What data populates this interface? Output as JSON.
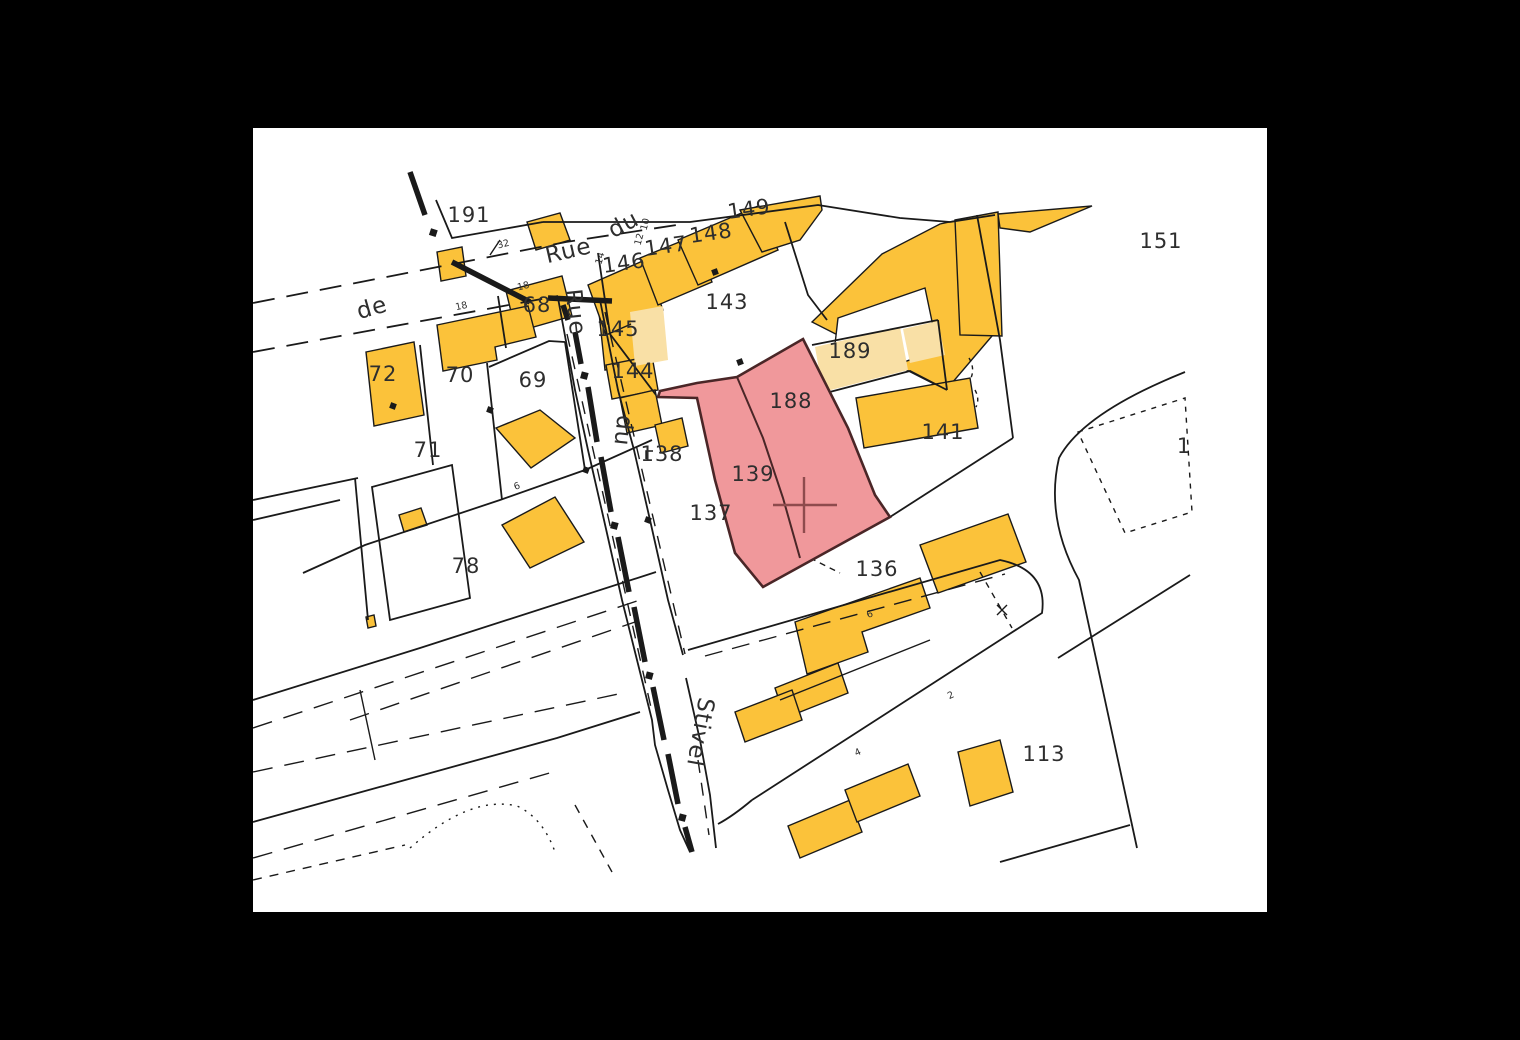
{
  "map": {
    "type": "cadastral-parcel-map",
    "colors": {
      "background": "#000000",
      "canvas": "#ffffff",
      "building": "#FBC23A",
      "building_light": "#F9E0A6",
      "highlight_fill": "#F0989B",
      "highlight_stroke": "#4A2627",
      "cross": "#8E4B4D",
      "line": "#1A1A1A",
      "label": "#2E2E2E"
    },
    "highlighted_parcels": [
      "139",
      "188"
    ],
    "selection_marker": {
      "shape": "cross",
      "x": 551,
      "y": 377
    },
    "parcel_labels": [
      {
        "text": "191",
        "x": 216,
        "y": 94,
        "rotate": 0
      },
      {
        "text": "149",
        "x": 497,
        "y": 88,
        "rotate": -8
      },
      {
        "text": "148",
        "x": 459,
        "y": 112,
        "rotate": -8
      },
      {
        "text": "147",
        "x": 414,
        "y": 125,
        "rotate": -8
      },
      {
        "text": "146",
        "x": 372,
        "y": 142,
        "rotate": -8
      },
      {
        "text": "143",
        "x": 474,
        "y": 181,
        "rotate": 0
      },
      {
        "text": "68",
        "x": 284,
        "y": 184,
        "rotate": 0
      },
      {
        "text": "145",
        "x": 365,
        "y": 208,
        "rotate": 0
      },
      {
        "text": "144",
        "x": 380,
        "y": 250,
        "rotate": 0
      },
      {
        "text": "189",
        "x": 597,
        "y": 230,
        "rotate": 0
      },
      {
        "text": "188",
        "x": 538,
        "y": 280,
        "rotate": 0
      },
      {
        "text": "141",
        "x": 690,
        "y": 311,
        "rotate": 0
      },
      {
        "text": "151",
        "x": 908,
        "y": 120,
        "rotate": 0
      },
      {
        "text": "72",
        "x": 130,
        "y": 253,
        "rotate": 0
      },
      {
        "text": "70",
        "x": 207,
        "y": 254,
        "rotate": 0
      },
      {
        "text": "69",
        "x": 280,
        "y": 259,
        "rotate": 0
      },
      {
        "text": "71",
        "x": 175,
        "y": 329,
        "rotate": 0
      },
      {
        "text": "138",
        "x": 409,
        "y": 333,
        "rotate": 0
      },
      {
        "text": "139",
        "x": 500,
        "y": 353,
        "rotate": 0
      },
      {
        "text": "137",
        "x": 458,
        "y": 392,
        "rotate": 0
      },
      {
        "text": "78",
        "x": 213,
        "y": 445,
        "rotate": 0
      },
      {
        "text": "136",
        "x": 624,
        "y": 448,
        "rotate": 0
      },
      {
        "text": "113",
        "x": 791,
        "y": 633,
        "rotate": 0
      },
      {
        "text": "1",
        "x": 931,
        "y": 325,
        "rotate": 0
      }
    ],
    "street_labels": [
      {
        "text": "Rue",
        "x": 317,
        "y": 130,
        "rotate": -13,
        "size": 24
      },
      {
        "text": "du",
        "x": 374,
        "y": 103,
        "rotate": -28,
        "size": 24
      },
      {
        "text": "de",
        "x": 121,
        "y": 187,
        "rotate": -16,
        "size": 24
      },
      {
        "text": "Rue",
        "x": 315,
        "y": 185,
        "rotate": 84,
        "size": 23
      },
      {
        "text": "du",
        "x": 363,
        "y": 302,
        "rotate": 96,
        "size": 23
      },
      {
        "text": "Stivel",
        "x": 440,
        "y": 603,
        "rotate": 100,
        "size": 21
      }
    ],
    "house_numbers": [
      {
        "text": "32",
        "x": 251,
        "y": 119,
        "rotate": -14
      },
      {
        "text": "18",
        "x": 271,
        "y": 161,
        "rotate": -14
      },
      {
        "text": "18",
        "x": 209,
        "y": 181,
        "rotate": -12
      },
      {
        "text": "14",
        "x": 350,
        "y": 131,
        "rotate": -75
      },
      {
        "text": "12",
        "x": 389,
        "y": 112,
        "rotate": -75
      },
      {
        "text": "10",
        "x": 395,
        "y": 97,
        "rotate": -75
      },
      {
        "text": "6",
        "x": 265,
        "y": 361,
        "rotate": -20
      },
      {
        "text": "6",
        "x": 618,
        "y": 489,
        "rotate": -25
      },
      {
        "text": "2",
        "x": 699,
        "y": 570,
        "rotate": -25
      },
      {
        "text": "4",
        "x": 606,
        "y": 627,
        "rotate": -25
      }
    ]
  }
}
